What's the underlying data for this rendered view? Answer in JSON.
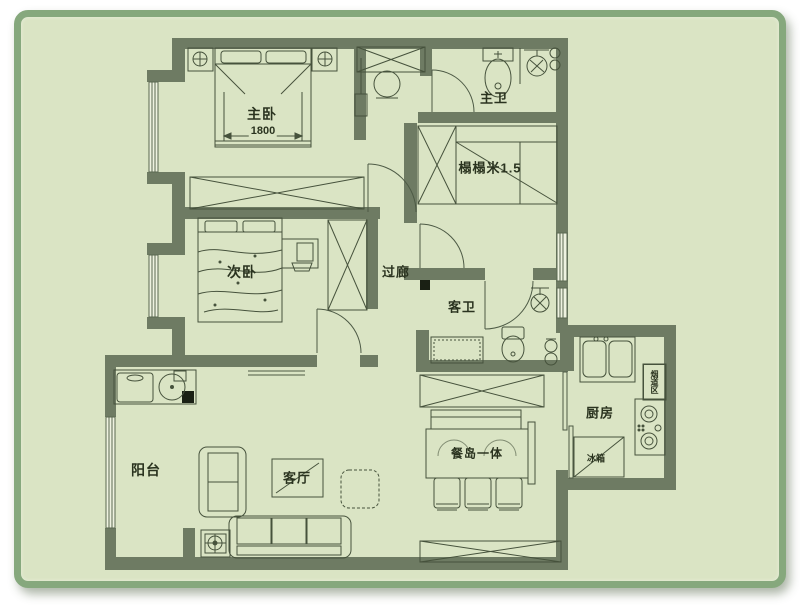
{
  "page": {
    "type": "apartment-floor-plan"
  },
  "colors": {
    "canvas": "#ffffff",
    "card_border": "#86a87d",
    "card_background": "#dae4c4",
    "wall": "#6e7b63",
    "line": "#46523c",
    "text": "#2a331f"
  },
  "rooms": {
    "master_bedroom": "主卧",
    "master_bath": "主卫",
    "tatami_room": "榻榻米1.5",
    "second_bedroom": "次卧",
    "corridor": "过廊",
    "guest_bath": "客卫",
    "kitchen": "厨房",
    "balcony": "阳台",
    "living_room": "客厅",
    "dining_island": "餐岛一体"
  },
  "annotations": {
    "bed_width": "1800",
    "fridge": "冰箱",
    "flue": "烟道区"
  }
}
